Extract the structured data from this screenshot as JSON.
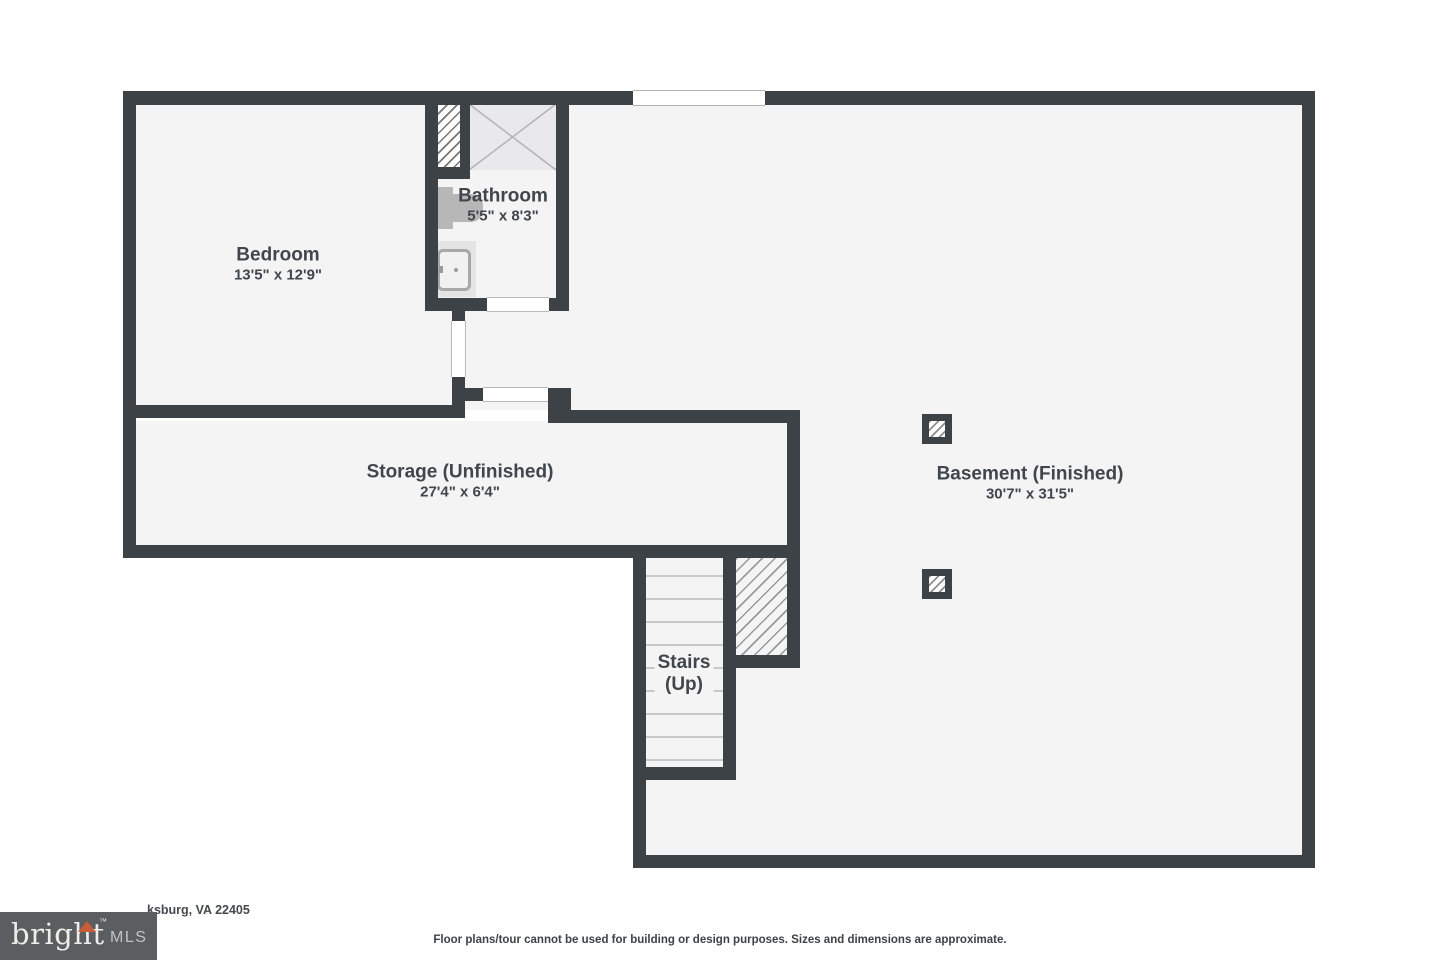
{
  "rooms": {
    "bedroom": {
      "name": "Bedroom",
      "dims": "13'5\" x 12'9\""
    },
    "bathroom": {
      "name": "Bathroom",
      "dims": "5'5\" x 8'3\""
    },
    "storage": {
      "name": "Storage (Unfinished)",
      "dims": "27'4\" x 6'4\""
    },
    "basement": {
      "name": "Basement (Finished)",
      "dims": "30'7\" x 31'5\""
    },
    "stairs": {
      "name": "Stairs",
      "direction": "(Up)"
    }
  },
  "footer": {
    "address_visible": "ksburg, VA 22405",
    "disclaimer": "Floor plans/tour cannot be used for building or design purposes. Sizes and dimensions are approximate."
  },
  "logo": {
    "brand": "bright",
    "mls": "MLS",
    "tm": "™"
  },
  "colors": {
    "wall": "#3d4247",
    "floor": "#f4f4f5",
    "label_text": "#40464c",
    "logo_background": "#5b5e61",
    "logo_accent": "#c85c36"
  }
}
